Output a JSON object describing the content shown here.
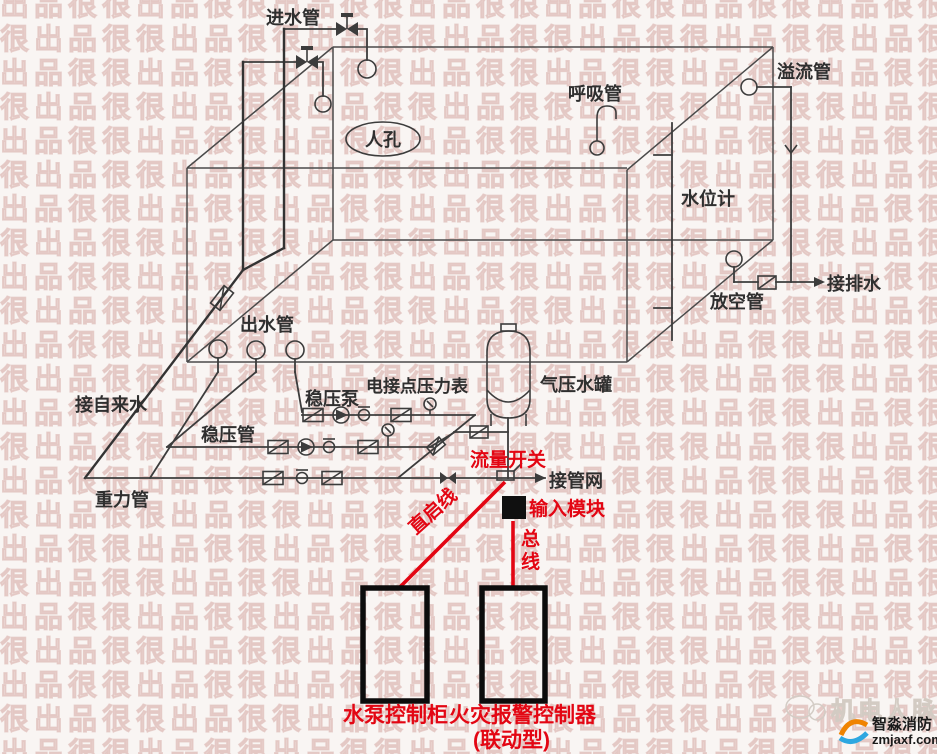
{
  "diagram": {
    "labels": {
      "inlet_pipe": "进水管",
      "manhole": "人孔",
      "breather_pipe": "呼吸管",
      "overflow_pipe": "溢流管",
      "water_level_gauge": "水位计",
      "vent_pipe": "放空管",
      "to_drainage": "接排水",
      "to_tap_water": "接自来水",
      "outlet_pipe": "出水管",
      "stabilizing_pump": "稳压泵",
      "contact_pressure_gauge": "电接点压力表",
      "pressure_water_tank": "气压水罐",
      "stabilizing_pipe": "稳压管",
      "gravity_pipe": "重力管",
      "to_pipe_network": "接管网"
    },
    "red_annotations": {
      "flow_switch": "流量开关",
      "input_module": "输入模块",
      "direct_start_line": "直启线",
      "bus_char_1": "总",
      "bus_char_2": "线",
      "pump_control_cabinet": "水泵控制柜",
      "fire_alarm_controller": "火灾报警控制器",
      "fire_alarm_controller_type": "(联动型)"
    },
    "colors": {
      "annotation_red": "#e30613",
      "line_gray": "#3c3c3c",
      "box_black": "#0c0c0c"
    }
  },
  "watermark": {
    "tile_text": "出品很很",
    "brand_text": "机电人脉",
    "logo_name": "智淼消防",
    "logo_site": "zmjaxf.com"
  }
}
